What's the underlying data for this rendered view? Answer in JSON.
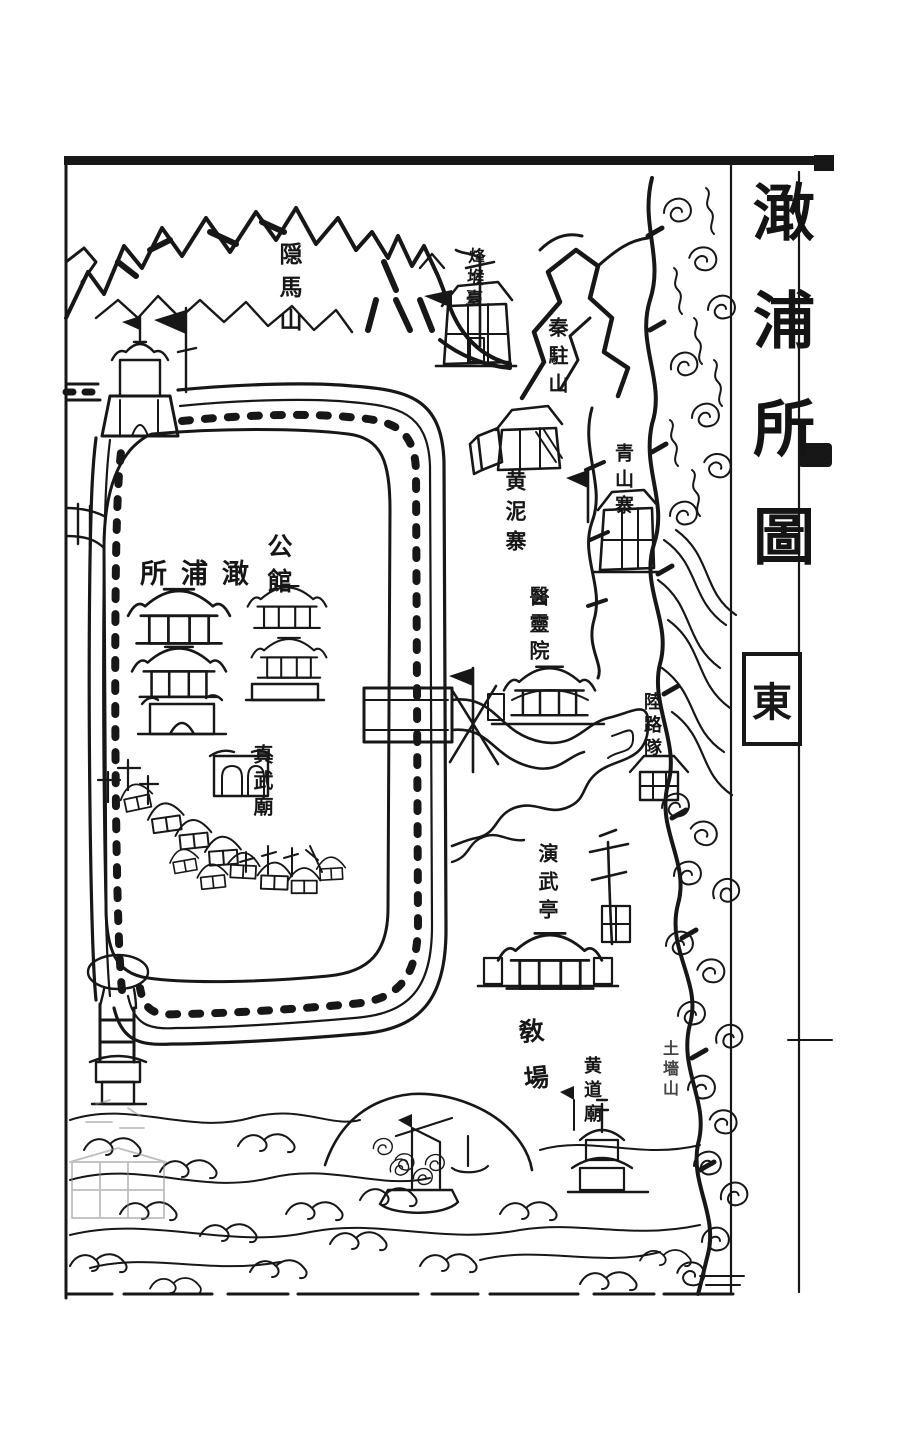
{
  "page": {
    "title": "澉浦所圖",
    "compass_east": "東"
  },
  "colors": {
    "ink": "#171717",
    "paper": "#ffffff"
  },
  "labels": [
    {
      "id": "yinma-shan",
      "text": "隠馬山"
    },
    {
      "id": "fenghou-tai",
      "text": "烽堠臺"
    },
    {
      "id": "qinzhu-shan",
      "text": "秦駐山"
    },
    {
      "id": "huangni-zhai",
      "text": "黄泥寨"
    },
    {
      "id": "qingshan-zhai",
      "text": "青山寨"
    },
    {
      "id": "ganpu-suo",
      "text": "所浦澉"
    },
    {
      "id": "gong-guan",
      "text": "公館"
    },
    {
      "id": "yiling-yuan",
      "text": "醫靈院"
    },
    {
      "id": "zhenwu-miao",
      "text": "真武廟"
    },
    {
      "id": "lulu-dui",
      "text": "陸路隊"
    },
    {
      "id": "yanwu-ting",
      "text": "演武亭"
    },
    {
      "id": "jiao-chang",
      "text": "敎場"
    },
    {
      "id": "huangdao-miao",
      "text": "黄道廟"
    },
    {
      "id": "tuqiang-shan",
      "text": "土墻山"
    }
  ]
}
